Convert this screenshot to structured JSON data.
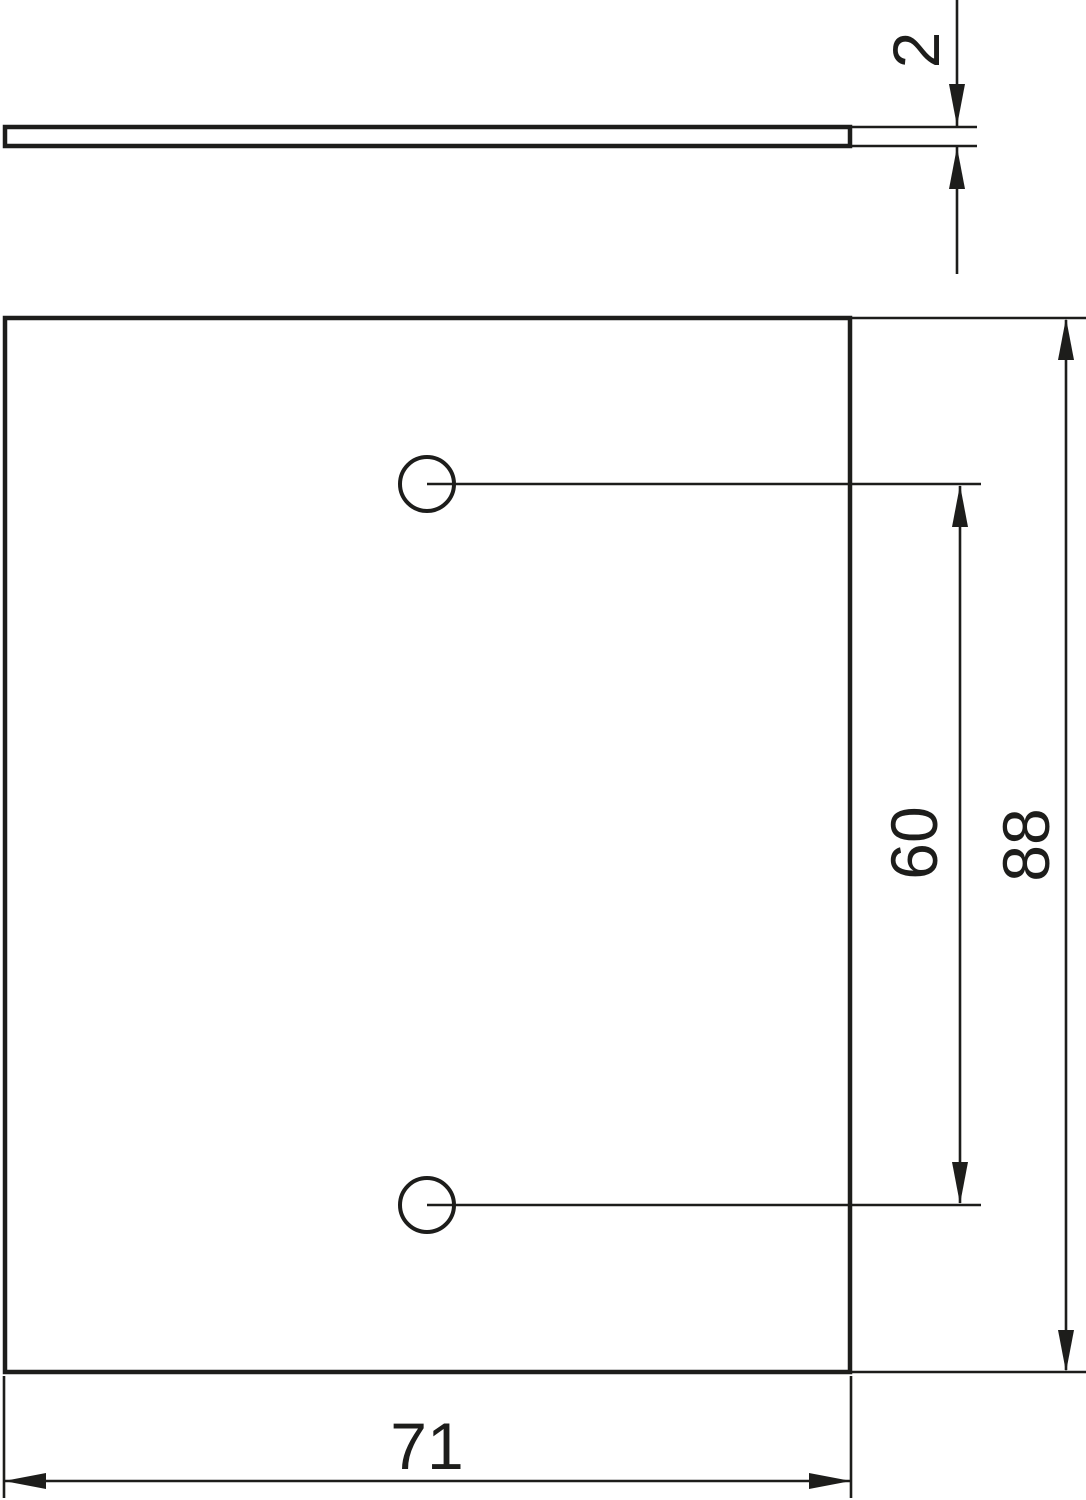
{
  "page": {
    "background_color": "#ffffff",
    "line_color": "#1d1d1b"
  },
  "drawing": {
    "kind": "technical-dimension-drawing",
    "views": {
      "side_view": "thin plate profile (top)",
      "front_view": "rectangular plate with two holes (bottom)"
    },
    "dimensions": {
      "thickness": {
        "label": "2"
      },
      "hole_spacing": {
        "label": "60"
      },
      "plate_height": {
        "label": "88"
      },
      "plate_width": {
        "label": "71"
      }
    }
  }
}
